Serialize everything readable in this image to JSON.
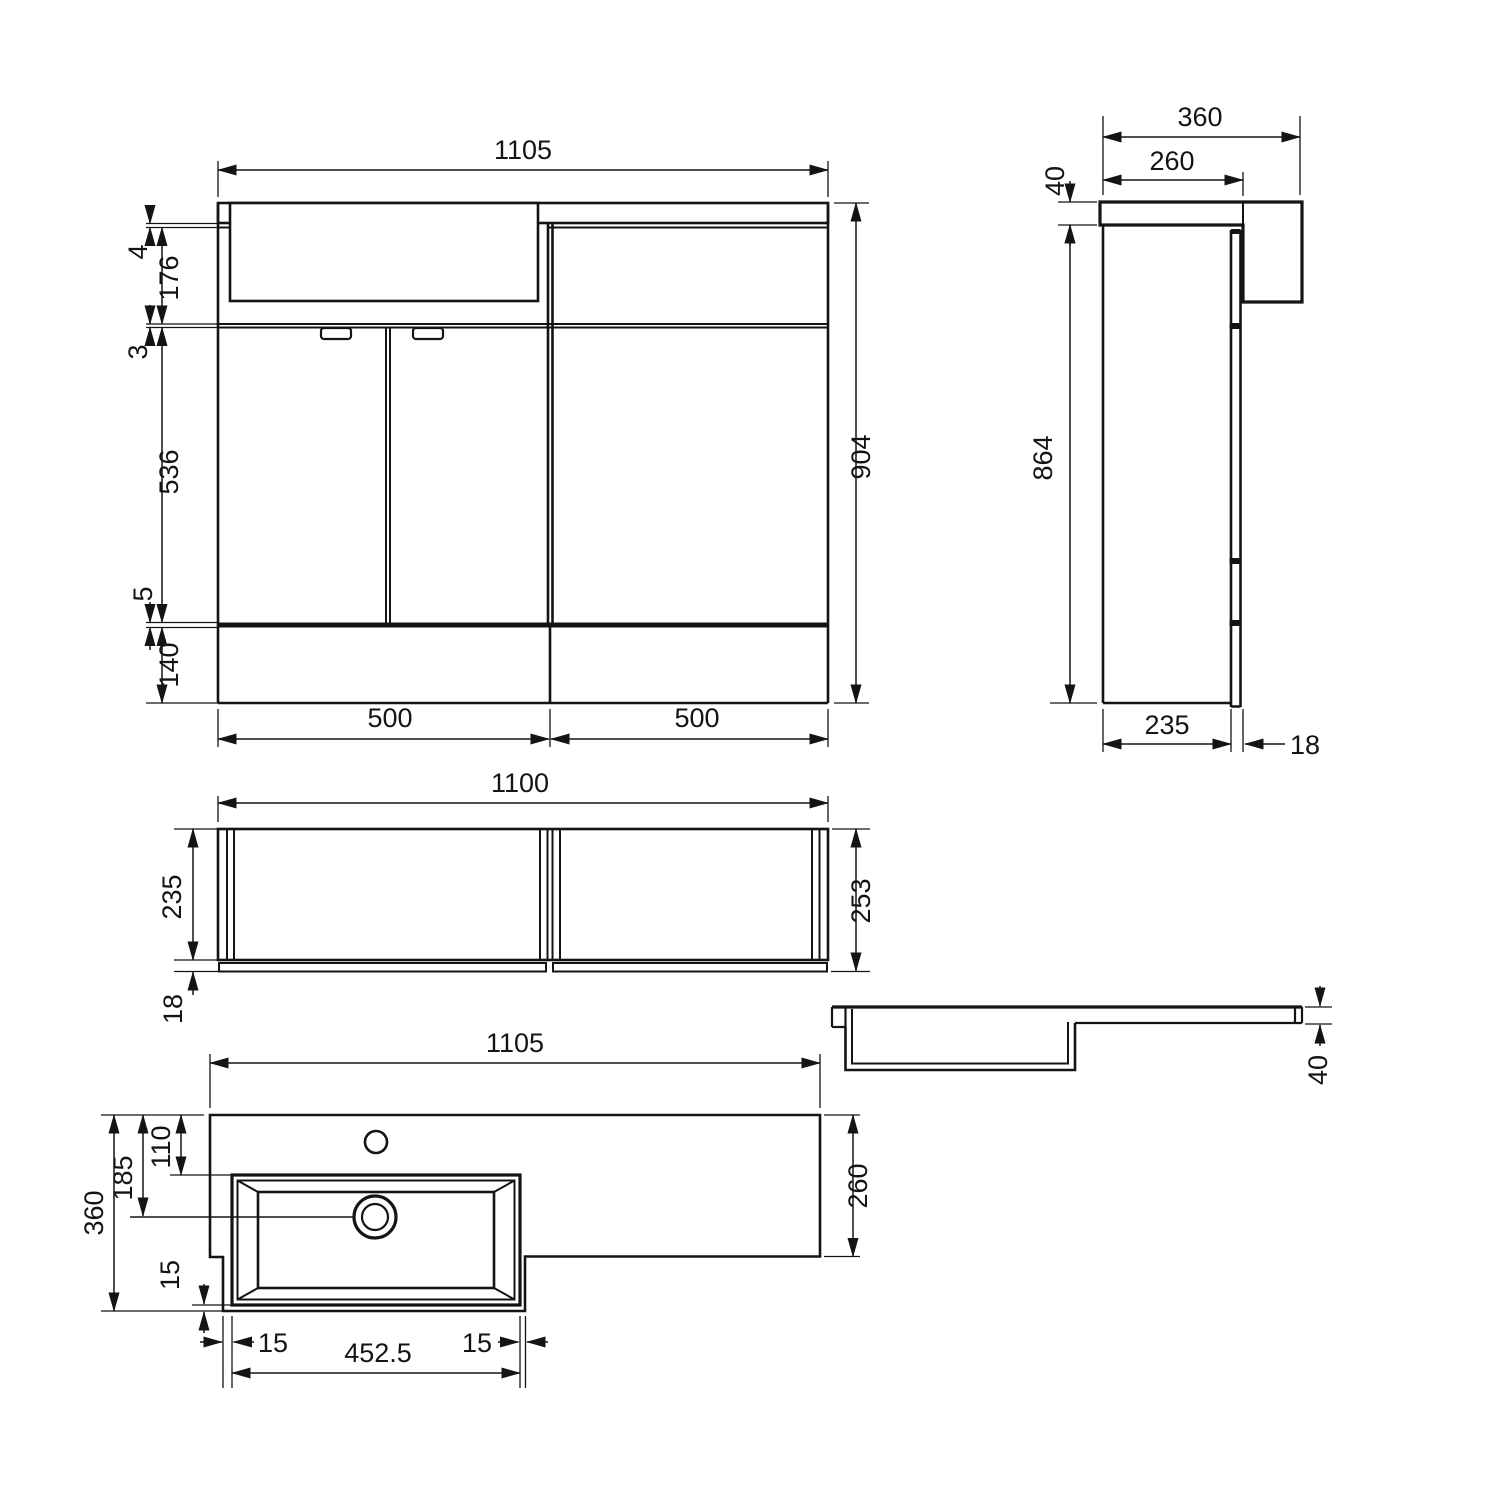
{
  "page": {
    "background": "#ffffff",
    "line_color": "#141414",
    "type": "technical-drawing"
  },
  "views": {
    "front": {
      "dims": {
        "overall_width": "1105",
        "counter_lip": "4",
        "basin_apron_height": "176",
        "gap_top": "3",
        "door_height": "536",
        "gap_bottom": "5",
        "plinth_height": "140",
        "overall_height": "904",
        "left_section_width": "500",
        "right_section_width": "500"
      }
    },
    "side": {
      "dims": {
        "counter_depth": "360",
        "wc_counter_depth": "260",
        "counter_thickness": "40",
        "carcass_height": "864",
        "carcass_depth": "235",
        "door_thickness": "18"
      }
    },
    "carcass_plan": {
      "dims": {
        "overall_width": "1100",
        "internal_depth": "235",
        "door_thickness": "18",
        "overall_depth": "253"
      }
    },
    "counter_section": {
      "dims": {
        "counter_thickness": "40"
      }
    },
    "counter_plan": {
      "dims": {
        "overall_width": "1105",
        "overall_depth": "360",
        "drain_center_offset": "185",
        "tap_center_offset": "110",
        "rim_front": "15",
        "rim_left": "15",
        "basin_inner_length": "452.5",
        "rim_right": "15",
        "right_depth": "260"
      }
    }
  }
}
